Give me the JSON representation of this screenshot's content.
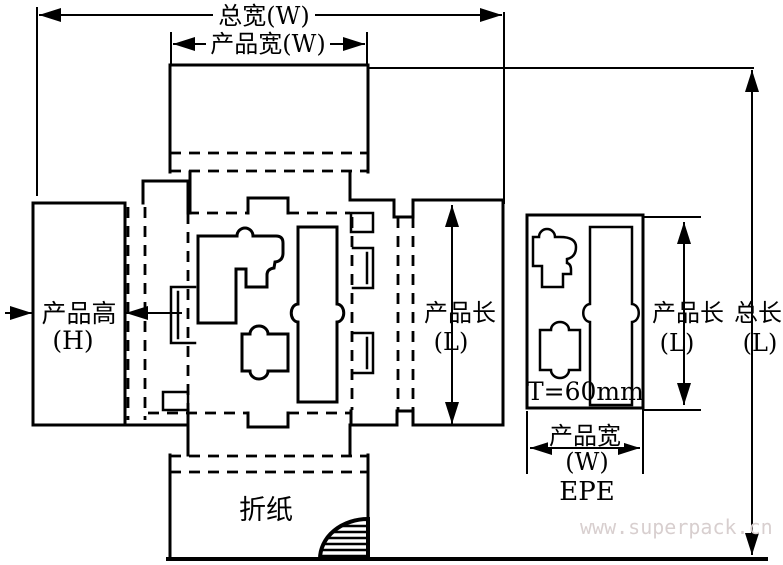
{
  "diagram": {
    "type": "carton-dieline-with-epe-foam-insert",
    "colors": {
      "line": "#000000",
      "background": "#ffffff",
      "watermark_text": "#d8cfcf"
    },
    "carton": {
      "total_width_label": "总宽(W)",
      "product_width_label": "产品宽(W)",
      "product_height_label_cn": "产品高",
      "product_height_label_en": "(H)",
      "product_length_label_cn": "产品长",
      "product_length_label_en": "(L)",
      "total_length_label_cn": "总长",
      "total_length_label_en": "(L)",
      "fold_paper_label": "折纸"
    },
    "epe": {
      "product_length_label_cn": "产品长",
      "product_length_label_en": "(L)",
      "product_width_label_cn": "产品宽",
      "product_width_label_en": "(W)",
      "thickness_label": "T=60mm",
      "material_label": "EPE"
    },
    "watermark": "www.superpack.cn"
  }
}
